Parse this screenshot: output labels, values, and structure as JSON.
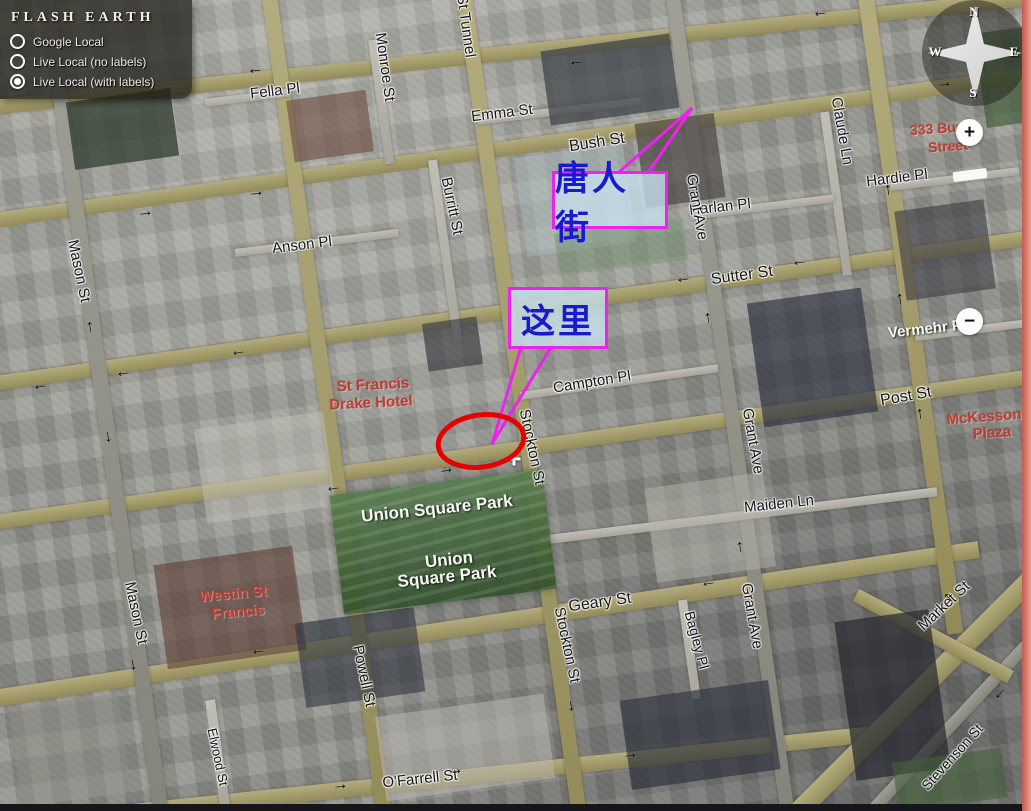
{
  "panel": {
    "title": "FLASH EARTH",
    "options": [
      {
        "label": "Google Local",
        "selected": false
      },
      {
        "label": "Live Local (no labels)",
        "selected": false
      },
      {
        "label": "Live Local (with labels)",
        "selected": true
      }
    ]
  },
  "compass": {
    "n": "N",
    "e": "E",
    "s": "S",
    "w": "W"
  },
  "controls": {
    "zoom_in": "+",
    "zoom_out": "−"
  },
  "map": {
    "center_marker_glyph": "+",
    "street_labels": [
      {
        "text": "Fella Pl",
        "x": 275,
        "y": 91,
        "rot": -7,
        "style": "dark",
        "size": 15
      },
      {
        "text": "Monroe St",
        "x": 385,
        "y": 67,
        "rot": 82,
        "style": "dark",
        "size": 15
      },
      {
        "text": "St Tunnel",
        "x": 466,
        "y": 26,
        "rot": 82,
        "style": "dark",
        "size": 15
      },
      {
        "text": "Emma St",
        "x": 502,
        "y": 113,
        "rot": -7,
        "style": "dark",
        "size": 15
      },
      {
        "text": "Bush St",
        "x": 597,
        "y": 143,
        "rot": -9,
        "style": "dark",
        "size": 16
      },
      {
        "text": "Claude Ln",
        "x": 842,
        "y": 131,
        "rot": 80,
        "style": "dark",
        "size": 15
      },
      {
        "text": "Hardie Pl",
        "x": 897,
        "y": 178,
        "rot": -7,
        "style": "dark",
        "size": 15
      },
      {
        "text": "Harlan Pl",
        "x": 720,
        "y": 207,
        "rot": -6,
        "style": "dark",
        "size": 15
      },
      {
        "text": "Grant Ave",
        "x": 697,
        "y": 207,
        "rot": 80,
        "style": "dark",
        "size": 15
      },
      {
        "text": "Anson Pl",
        "x": 302,
        "y": 245,
        "rot": -7,
        "style": "dark",
        "size": 15
      },
      {
        "text": "Mason St",
        "x": 79,
        "y": 271,
        "rot": 78,
        "style": "dark",
        "size": 15
      },
      {
        "text": "Burritt St",
        "x": 452,
        "y": 206,
        "rot": 78,
        "style": "dark",
        "size": 15
      },
      {
        "text": "Sutter St",
        "x": 742,
        "y": 276,
        "rot": -8,
        "style": "dark",
        "size": 16
      },
      {
        "text": "Post St",
        "x": 906,
        "y": 397,
        "rot": -10,
        "style": "dark",
        "size": 16
      },
      {
        "text": "Campton Pl",
        "x": 592,
        "y": 382,
        "rot": -9,
        "style": "dark",
        "size": 15
      },
      {
        "text": "Stockton St",
        "x": 532,
        "y": 447,
        "rot": 78,
        "style": "dark",
        "size": 15
      },
      {
        "text": "Maiden Ln",
        "x": 779,
        "y": 504,
        "rot": -6,
        "style": "dark",
        "size": 15
      },
      {
        "text": "Grant Ave",
        "x": 753,
        "y": 441,
        "rot": 80,
        "style": "dark",
        "size": 15
      },
      {
        "text": "Geary St",
        "x": 600,
        "y": 603,
        "rot": -8,
        "style": "dark",
        "size": 16
      },
      {
        "text": "Mason St",
        "x": 136,
        "y": 613,
        "rot": 78,
        "style": "dark",
        "size": 15
      },
      {
        "text": "Powell St",
        "x": 364,
        "y": 676,
        "rot": 78,
        "style": "dark",
        "size": 15
      },
      {
        "text": "Grant Ave",
        "x": 752,
        "y": 616,
        "rot": 80,
        "style": "dark",
        "size": 15
      },
      {
        "text": "Bagley Pl",
        "x": 697,
        "y": 640,
        "rot": 75,
        "style": "dark",
        "size": 14
      },
      {
        "text": "Stockton St",
        "x": 567,
        "y": 645,
        "rot": 78,
        "style": "dark",
        "size": 15
      },
      {
        "text": "Market St",
        "x": 944,
        "y": 606,
        "rot": -43,
        "style": "dark",
        "size": 15
      },
      {
        "text": "Stevenson St",
        "x": 952,
        "y": 757,
        "rot": -48,
        "style": "dark",
        "size": 14
      },
      {
        "text": "O'Farrell St",
        "x": 420,
        "y": 779,
        "rot": -6,
        "style": "dark",
        "size": 15
      },
      {
        "text": "Elwood St",
        "x": 218,
        "y": 757,
        "rot": 78,
        "style": "dark",
        "size": 13
      },
      {
        "text": "Union Square Park",
        "x": 437,
        "y": 509,
        "rot": -6,
        "style": "light",
        "size": 17
      },
      {
        "text": "Union",
        "x": 449,
        "y": 560,
        "rot": -6,
        "style": "light",
        "size": 17
      },
      {
        "text": "Square Park",
        "x": 447,
        "y": 577,
        "rot": -6,
        "style": "light",
        "size": 17
      },
      {
        "text": "Vermehr Pl",
        "x": 927,
        "y": 329,
        "rot": -6,
        "style": "light",
        "size": 15
      },
      {
        "text": "333 Bush",
        "x": 941,
        "y": 128,
        "rot": -4,
        "style": "red",
        "size": 14
      },
      {
        "text": "Street",
        "x": 948,
        "y": 146,
        "rot": -4,
        "style": "red",
        "size": 14
      },
      {
        "text": "McKesson",
        "x": 984,
        "y": 417,
        "rot": -4,
        "style": "red",
        "size": 15
      },
      {
        "text": "Plaza",
        "x": 992,
        "y": 433,
        "rot": -4,
        "style": "red",
        "size": 15
      },
      {
        "text": "St Francis",
        "x": 373,
        "y": 385,
        "rot": -3,
        "style": "red",
        "size": 15
      },
      {
        "text": "Drake Hotel",
        "x": 371,
        "y": 403,
        "rot": -3,
        "style": "red",
        "size": 15
      },
      {
        "text": "Westin St",
        "x": 233,
        "y": 594,
        "rot": -5,
        "style": "red",
        "size": 15
      },
      {
        "text": "Francis",
        "x": 238,
        "y": 612,
        "rot": -5,
        "style": "red",
        "size": 15
      }
    ],
    "arrows": [
      {
        "dir": "left",
        "x": 255,
        "y": 68,
        "rot": -6
      },
      {
        "dir": "left",
        "x": 576,
        "y": 60,
        "rot": -6
      },
      {
        "dir": "left",
        "x": 820,
        "y": 11,
        "rot": -6
      },
      {
        "dir": "left",
        "x": 683,
        "y": 277,
        "rot": -8
      },
      {
        "dir": "left",
        "x": 799,
        "y": 260,
        "rot": -8
      },
      {
        "dir": "left",
        "x": 40,
        "y": 384,
        "rot": -8
      },
      {
        "dir": "left",
        "x": 123,
        "y": 371,
        "rot": -8
      },
      {
        "dir": "left",
        "x": 238,
        "y": 350,
        "rot": -8
      },
      {
        "dir": "left",
        "x": 333,
        "y": 486,
        "rot": -8
      },
      {
        "dir": "left",
        "x": 708,
        "y": 581,
        "rot": -8
      },
      {
        "dir": "left",
        "x": 258,
        "y": 649,
        "rot": -8
      },
      {
        "dir": "left",
        "x": 998,
        "y": 692,
        "rot": -47
      },
      {
        "dir": "right",
        "x": 944,
        "y": 82,
        "rot": -6
      },
      {
        "dir": "right",
        "x": 145,
        "y": 211,
        "rot": -7
      },
      {
        "dir": "right",
        "x": 256,
        "y": 191,
        "rot": -7
      },
      {
        "dir": "right",
        "x": 446,
        "y": 468,
        "rot": -8
      },
      {
        "dir": "right",
        "x": 630,
        "y": 753,
        "rot": -6
      },
      {
        "dir": "right",
        "x": 340,
        "y": 784,
        "rot": -6
      },
      {
        "dir": "right",
        "x": 455,
        "y": 769,
        "rot": -6
      },
      {
        "dir": "up",
        "x": 90,
        "y": 326,
        "rot": -8
      },
      {
        "dir": "up",
        "x": 708,
        "y": 317,
        "rot": -8
      },
      {
        "dir": "up",
        "x": 740,
        "y": 546,
        "rot": -8
      },
      {
        "dir": "up",
        "x": 888,
        "y": 189,
        "rot": -8
      },
      {
        "dir": "up",
        "x": 900,
        "y": 298,
        "rot": -8
      },
      {
        "dir": "up",
        "x": 920,
        "y": 413,
        "rot": -8
      },
      {
        "dir": "up",
        "x": 948,
        "y": 597,
        "rot": -45
      },
      {
        "dir": "down",
        "x": 108,
        "y": 436,
        "rot": -8
      },
      {
        "dir": "down",
        "x": 133,
        "y": 664,
        "rot": -8
      },
      {
        "dir": "down",
        "x": 571,
        "y": 705,
        "rot": -8
      }
    ]
  },
  "annotations": {
    "chinatown": {
      "text": "唐人街",
      "box": {
        "x": 552,
        "y": 171,
        "w": 110,
        "h": 52
      },
      "pointer_points": "618,173 692,108 648,173"
    },
    "here": {
      "text": "这里",
      "box": {
        "x": 508,
        "y": 287,
        "w": 94,
        "h": 56
      },
      "pointer_points": "522,344 492,444 553,344"
    },
    "target_ellipse": {
      "cx": 481,
      "cy": 441,
      "rx": 43,
      "ry": 26,
      "rot": -8
    }
  },
  "colors": {
    "annotation_accent": "#ee22ee",
    "annotation_text": "#1a1acc",
    "target_red": "#e50000"
  }
}
